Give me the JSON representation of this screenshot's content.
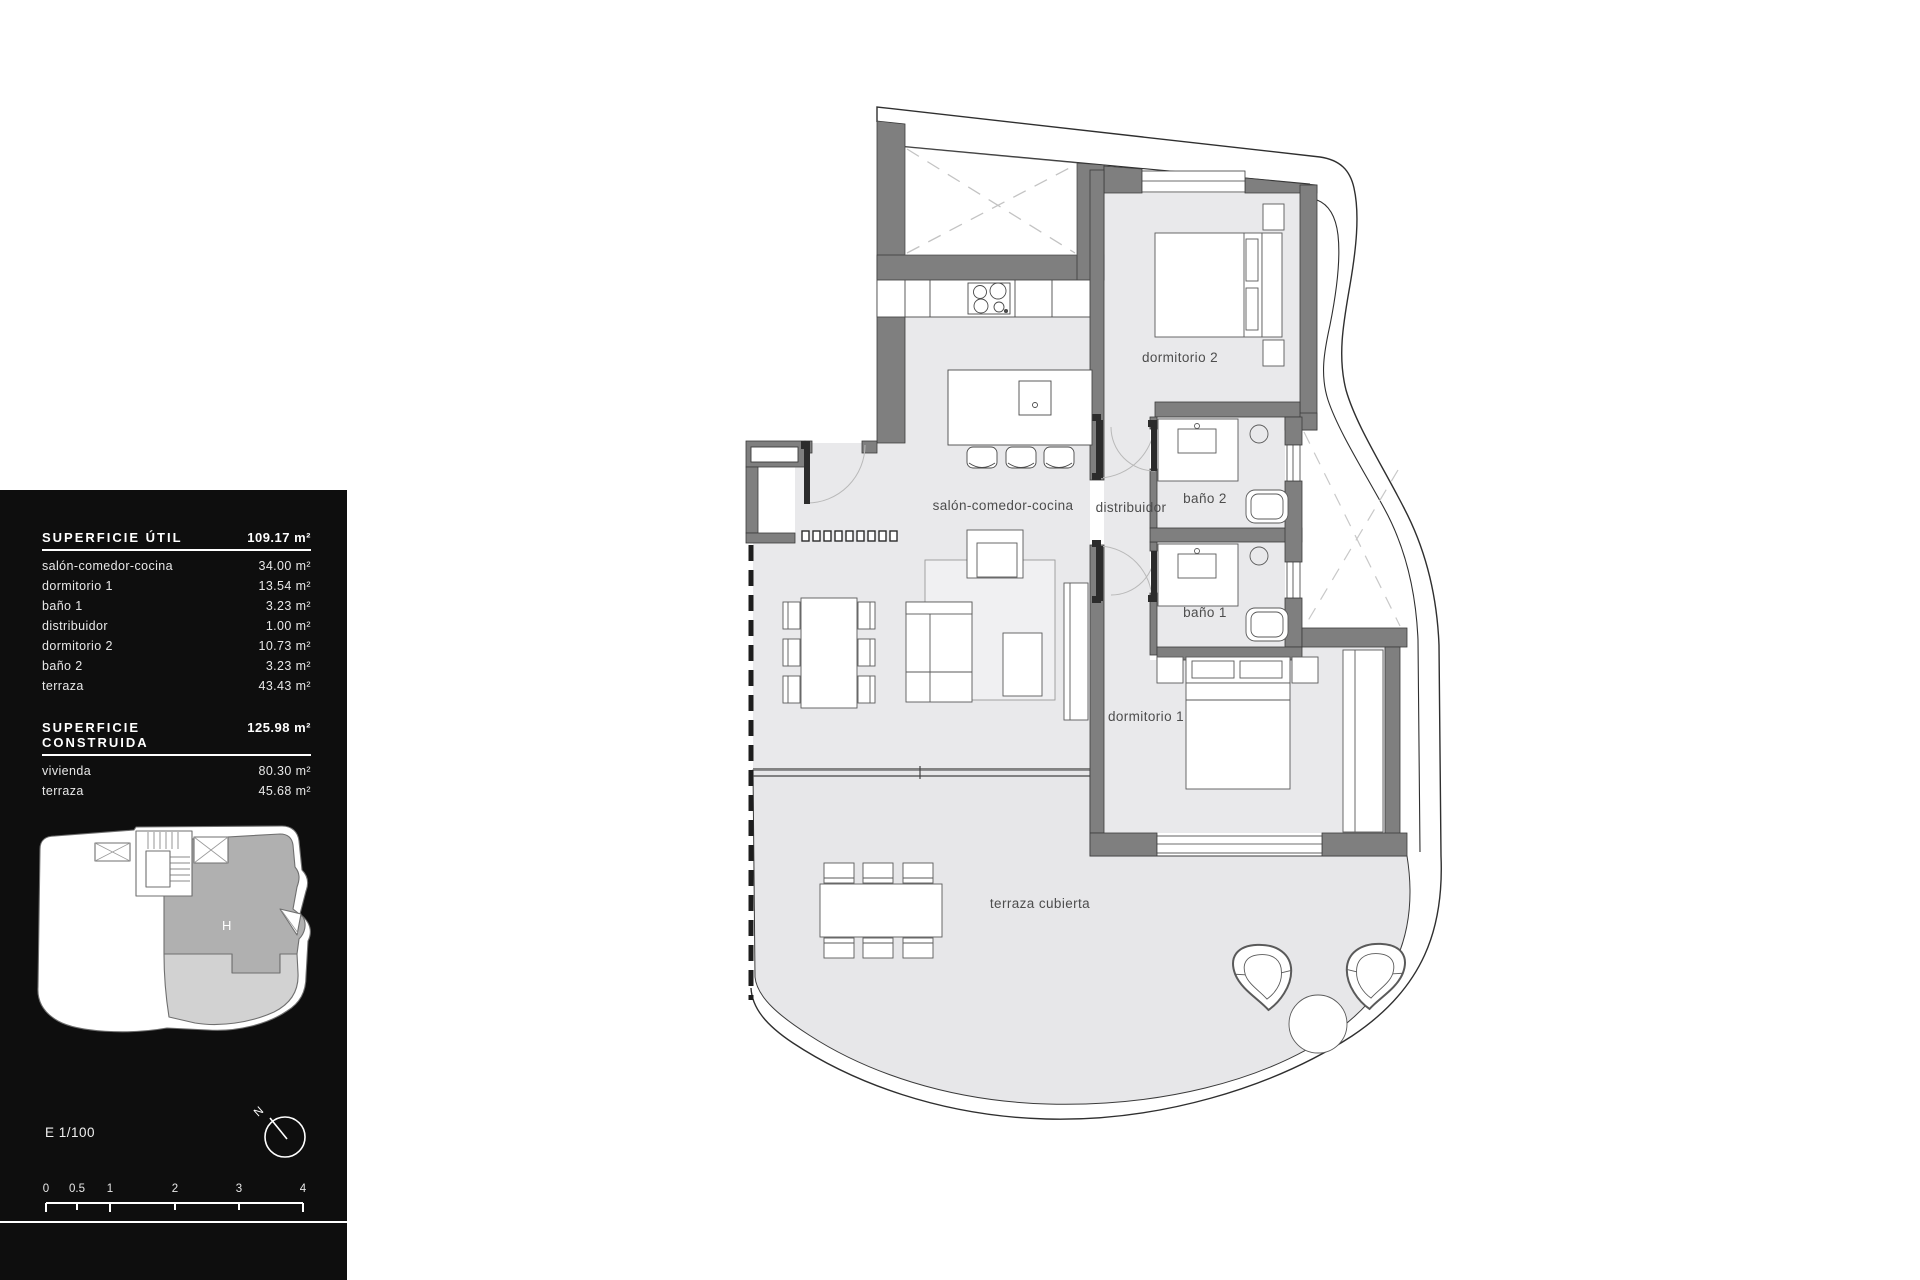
{
  "panel": {
    "superficie_util": {
      "title": "SUPERFICIE ÚTIL",
      "total": "109.17 m²",
      "rows": [
        {
          "label": "salón-comedor-cocina",
          "value": "34.00 m²"
        },
        {
          "label": "dormitorio 1",
          "value": "13.54 m²"
        },
        {
          "label": "baño 1",
          "value": "3.23 m²"
        },
        {
          "label": "distribuidor",
          "value": "1.00 m²"
        },
        {
          "label": "dormitorio 2",
          "value": "10.73 m²"
        },
        {
          "label": "baño 2",
          "value": "3.23 m²"
        },
        {
          "label": "terraza",
          "value": "43.43 m²"
        }
      ]
    },
    "superficie_construida": {
      "title": "SUPERFICIE CONSTRUIDA",
      "total": "125.98 m²",
      "rows": [
        {
          "label": "vivienda",
          "value": "80.30 m²"
        },
        {
          "label": "terraza",
          "value": "45.68 m²"
        }
      ]
    },
    "miniplan": {
      "unit_label": "H"
    },
    "scale_text": "E 1/100",
    "compass": {
      "north_label": "N"
    },
    "scalebar": {
      "ticks": [
        "0",
        "0.5",
        "1",
        "2",
        "3",
        "4"
      ]
    }
  },
  "plan": {
    "rooms": {
      "salon": "salón-comedor-cocina",
      "distribuidor": "distribuidor",
      "bano2": "baño 2",
      "bano1": "baño 1",
      "dormitorio2": "dormitorio 2",
      "dormitorio1": "dormitorio 1",
      "terraza": "terraza cubierta"
    }
  },
  "colors": {
    "panel_bg": "#0e0e0e",
    "wall": "#7f7f7f",
    "room_fill": "#e9e9eb",
    "terrace_fill": "#e7e7e9",
    "line": "#3a3a3a",
    "mini_unit_fill": "#b0b0b0",
    "mini_terrace_fill": "#d2d2d2"
  }
}
